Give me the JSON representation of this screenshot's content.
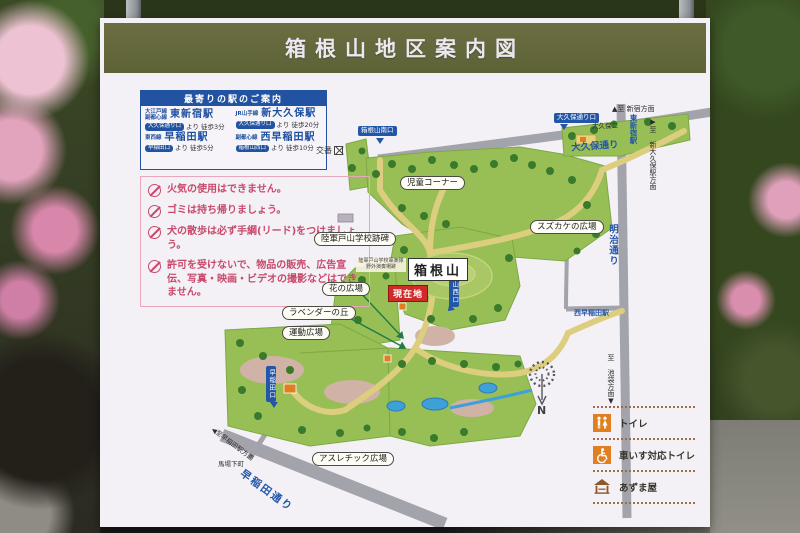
{
  "sign": {
    "title": "箱根山地区案内図"
  },
  "station_box": {
    "header": "最寄りの駅のご案内",
    "items": [
      {
        "lines": "大江戸線\n副都心線",
        "station": "東新宿駅",
        "gate": "大久保通り口",
        "walk": "より 徒歩3分"
      },
      {
        "lines": "JR山手線",
        "station": "新大久保駅",
        "gate": "大久保通り口",
        "walk": "より 徒歩20分"
      },
      {
        "lines": "東西線",
        "station": "早稲田駅",
        "gate": "早稲田口",
        "walk": "より 徒歩5分"
      },
      {
        "lines": "副都心線",
        "station": "西早稲田駅",
        "gate": "箱根山西口",
        "walk": "より 徒歩10分"
      }
    ]
  },
  "rules": [
    {
      "icon": "no-fire-icon",
      "text": "火気の使用はできません。"
    },
    {
      "icon": "take-trash-home-icon",
      "text": "ゴミは持ち帰りましょう。"
    },
    {
      "icon": "dog-leash-icon",
      "text": "犬の散歩は必ず手綱(リード)をつけましょう。"
    },
    {
      "icon": "no-unauthorized-icon",
      "text": "許可を受けないで、物品の販売、広告宣伝、写真・映画・ビデオの撮影などはできません。"
    }
  ],
  "map": {
    "areas": {
      "kodomo": "児童コーナー",
      "suzukake": "スズカケの広場",
      "hana": "花の広場",
      "lavender": "ラベンダーの丘",
      "undo": "運動広場",
      "athletic": "アスレチック広場"
    },
    "monument": "陸軍戸山学校跡碑",
    "band_note": "陸軍戸山学校軍楽隊\n野外演奏場跡",
    "peak": "箱根山",
    "current_location": "現在地",
    "police_box": "交番",
    "entrances": {
      "south": "箱根山南口",
      "okubo": "大久保通り口",
      "west": "箱根山西口",
      "waseda": "早稲田口"
    },
    "streets": {
      "okubo": "大久保通り",
      "meiji": "明治通り",
      "waseda": "早稲田通り"
    },
    "map_stations": {
      "higashi_shinjuku": "東新宿駅",
      "nishi_waseda": "西早稲田駅"
    },
    "directions": {
      "shinjuku": "▲至 新宿方面",
      "shin_okubo": "▶至 新大久保駅方面",
      "ikebukuro": "至 池袋方面▼",
      "waseda_station": "◀至早稲田駅方面"
    },
    "crossings": {
      "babashitacho": "馬場下町",
      "okubo2": "大久保二"
    },
    "compass_n": "N"
  },
  "legend": {
    "items": [
      {
        "icon": "toilet-icon",
        "label": "トイレ"
      },
      {
        "icon": "wheelchair-toilet-icon",
        "label": "車いす対応トイレ"
      },
      {
        "icon": "gazebo-icon",
        "label": "あずま屋"
      }
    ]
  },
  "colors": {
    "header_olive": "#64683c",
    "board": "#eae7f1",
    "accent_blue": "#2253a2",
    "rule_pink": "#c8496b",
    "park_green": "#97bf56",
    "path_tan": "#ddce7f",
    "road_gray": "#a3a3ab",
    "pond_blue": "#3f9fd8",
    "legend_orange": "#e07f1f",
    "current_red": "#cf2b2b"
  }
}
